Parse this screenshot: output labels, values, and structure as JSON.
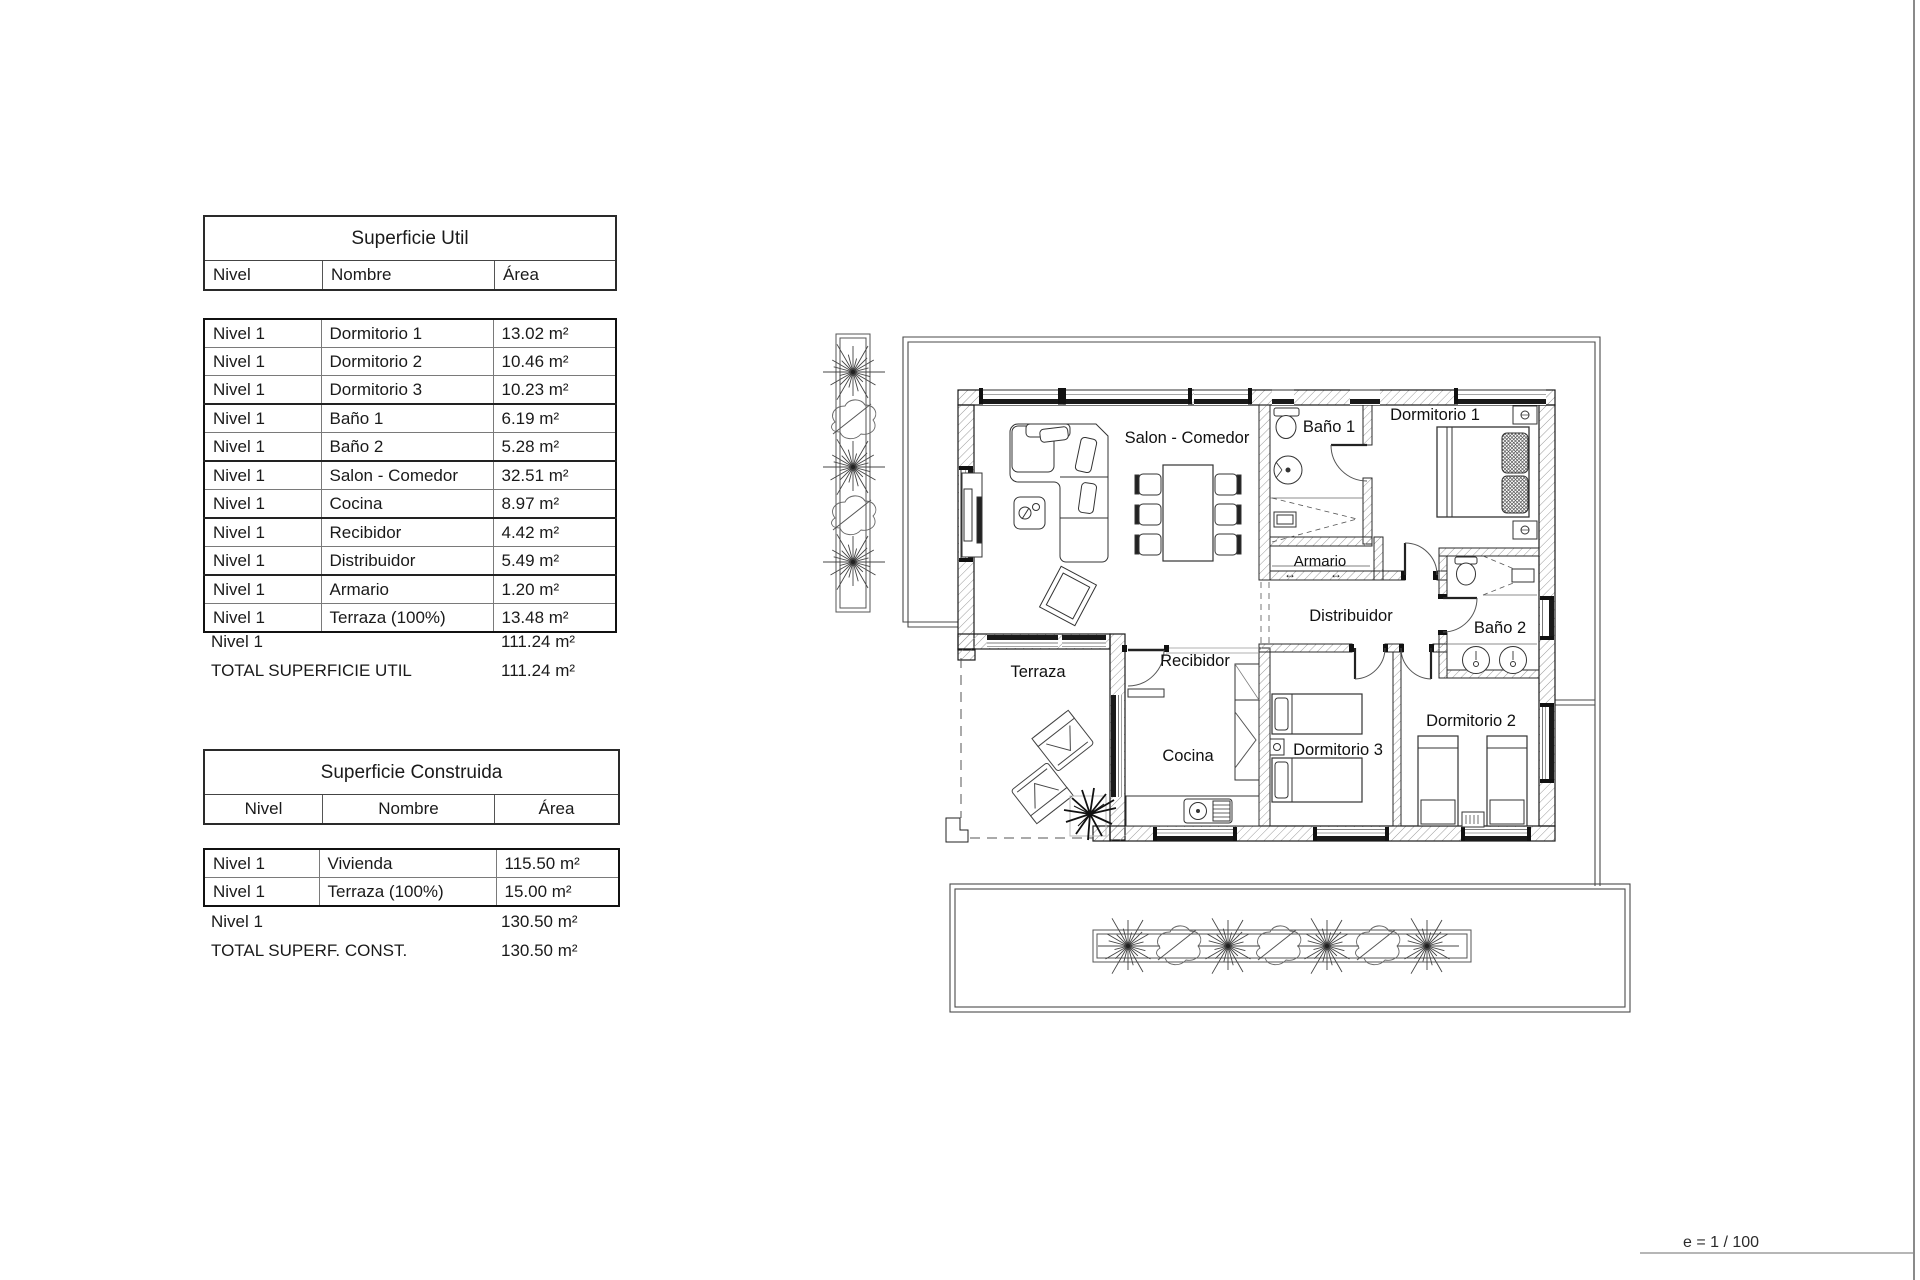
{
  "su": {
    "title": "Superficie Util",
    "col_nivel": "Nivel",
    "col_nombre": "Nombre",
    "col_area": "Área",
    "rows": [
      {
        "nivel": "Nivel 1",
        "nombre": "Dormitorio 1",
        "area": "13.02 m²"
      },
      {
        "nivel": "Nivel 1",
        "nombre": "Dormitorio 2",
        "area": "10.46 m²"
      },
      {
        "nivel": "Nivel 1",
        "nombre": "Dormitorio 3",
        "area": "10.23 m²"
      },
      {
        "nivel": "Nivel 1",
        "nombre": "Baño 1",
        "area": "6.19 m²"
      },
      {
        "nivel": "Nivel 1",
        "nombre": "Baño 2",
        "area": "5.28 m²"
      },
      {
        "nivel": "Nivel 1",
        "nombre": "Salon - Comedor",
        "area": "32.51 m²"
      },
      {
        "nivel": "Nivel 1",
        "nombre": "Cocina",
        "area": "8.97 m²"
      },
      {
        "nivel": "Nivel 1",
        "nombre": "Recibidor",
        "area": "4.42 m²"
      },
      {
        "nivel": "Nivel 1",
        "nombre": "Distribuidor",
        "area": "5.49 m²"
      },
      {
        "nivel": "Nivel 1",
        "nombre": "Armario",
        "area": "1.20 m²"
      },
      {
        "nivel": "Nivel 1",
        "nombre": "Terraza (100%)",
        "area": "13.48 m²"
      }
    ],
    "subtotal_nivel": "Nivel 1",
    "subtotal_area": "111.24 m²",
    "total_label": "TOTAL SUPERFICIE UTIL",
    "total_area": "111.24 m²"
  },
  "sc": {
    "title": "Superficie Construida",
    "col_nivel": "Nivel",
    "col_nombre": "Nombre",
    "col_area": "Área",
    "rows": [
      {
        "nivel": "Nivel 1",
        "nombre": "Vivienda",
        "area": "115.50 m²"
      },
      {
        "nivel": "Nivel 1",
        "nombre": "Terraza (100%)",
        "area": "15.00 m²"
      }
    ],
    "subtotal_nivel": "Nivel 1",
    "subtotal_area": "130.50 m²",
    "total_label": "TOTAL SUPERF. CONST.",
    "total_area": "130.50 m²"
  },
  "plan": {
    "labels": {
      "salon": "Salon - Comedor",
      "bano1": "Baño 1",
      "dormitorio1": "Dormitorio 1",
      "armario": "Armario",
      "distribuidor": "Distribuidor",
      "bano2": "Baño 2",
      "terraza": "Terraza",
      "recibidor": "Recibidor",
      "cocina": "Cocina",
      "dormitorio3": "Dormitorio 3",
      "dormitorio2": "Dormitorio 2"
    },
    "armario_arrow": "↔"
  },
  "footer": {
    "scale": "e = 1 / 100"
  }
}
